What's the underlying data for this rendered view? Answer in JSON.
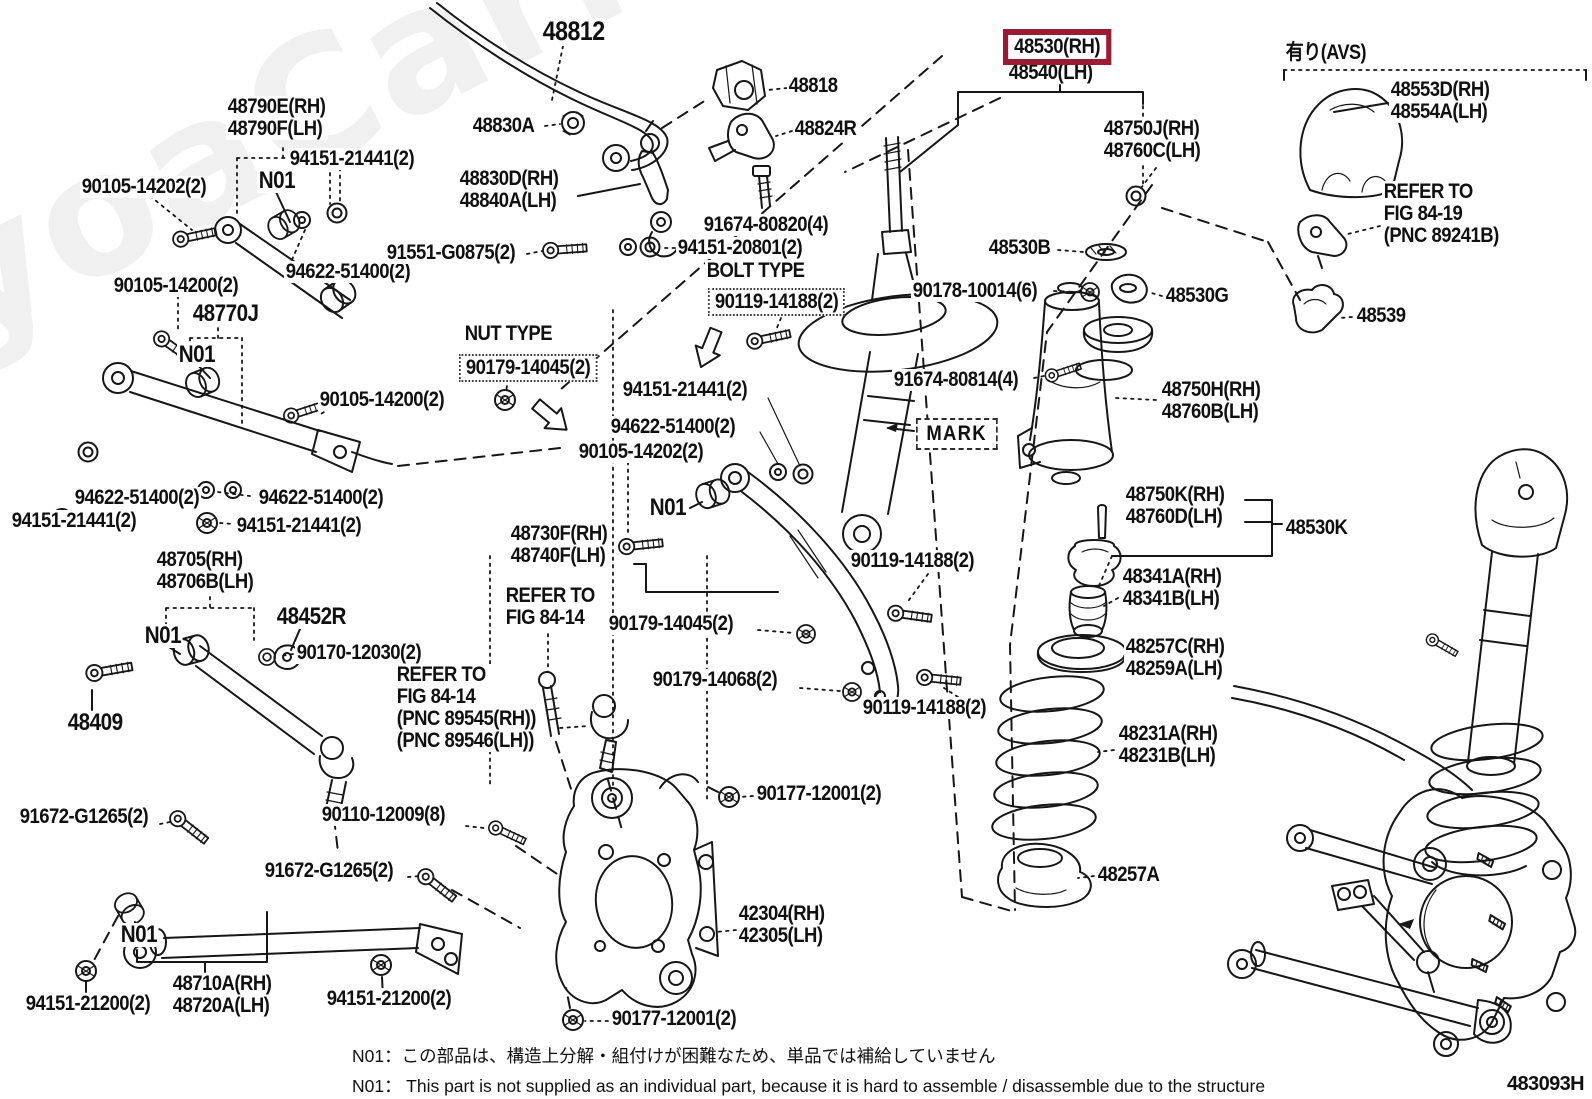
{
  "page": {
    "background": "#ffffff",
    "line_color": "#161616",
    "highlight_color": "#9c1b33",
    "diagram_code": "483093H",
    "watermark": "ToyoaCarMine.ru"
  },
  "notes": {
    "jp": "N01：この部品は、構造上分解・組付けが困難なため、単品では補給していません",
    "en": "N01： This part is not supplied as an individual part, because it is hard to assemble / disassemble due to the structure"
  },
  "labels": [
    {
      "name": "part-48812",
      "text": "48812",
      "x": 541,
      "y": 18,
      "fs": 27
    },
    {
      "name": "part-48790e-48790f",
      "text": "48790E(RH)\n48790F(LH)",
      "x": 226,
      "y": 96
    },
    {
      "name": "note-n01-a",
      "text": "N01",
      "x": 257,
      "y": 169,
      "fs": 24
    },
    {
      "name": "part-94151-21441-a",
      "text": "94151-21441(2)",
      "x": 288,
      "y": 148
    },
    {
      "name": "part-90105-14202-a",
      "text": "90105-14202(2)",
      "x": 80,
      "y": 176
    },
    {
      "name": "part-94622-51400-a",
      "text": "94622-51400(2)",
      "x": 284,
      "y": 261
    },
    {
      "name": "part-91551-g0875",
      "text": "91551-G0875(2)",
      "x": 385,
      "y": 242
    },
    {
      "name": "part-48830a",
      "text": "48830A",
      "x": 471,
      "y": 115
    },
    {
      "name": "part-48830d-48840a",
      "text": "48830D(RH)\n48840A(LH)",
      "x": 458,
      "y": 168
    },
    {
      "name": "part-48818",
      "text": "48818",
      "x": 787,
      "y": 75
    },
    {
      "name": "part-48824r",
      "text": "48824R",
      "x": 793,
      "y": 118
    },
    {
      "name": "part-91674-80820",
      "text": "91674-80820(4)",
      "x": 702,
      "y": 214
    },
    {
      "name": "part-94151-20801",
      "text": "94151-20801(2)",
      "x": 676,
      "y": 237
    },
    {
      "name": "caption-bolt-type",
      "text": "BOLT TYPE",
      "x": 705,
      "y": 260
    },
    {
      "name": "part-90119-14188-boxed",
      "text": "90119-14188(2)",
      "x": 708,
      "y": 288,
      "cls": "dotted-box"
    },
    {
      "name": "caption-nut-type",
      "text": "NUT TYPE",
      "x": 463,
      "y": 323
    },
    {
      "name": "part-90179-14045-boxed",
      "text": "90179-14045(2)",
      "x": 459,
      "y": 354,
      "cls": "dotted-box"
    },
    {
      "name": "part-90105-14200-a",
      "text": "90105-14200(2)",
      "x": 112,
      "y": 275
    },
    {
      "name": "part-48770j",
      "text": "48770J",
      "x": 191,
      "y": 302,
      "fs": 24
    },
    {
      "name": "note-n01-b",
      "text": "N01",
      "x": 177,
      "y": 343,
      "fs": 24
    },
    {
      "name": "part-90105-14200-b",
      "text": "90105-14200(2)",
      "x": 318,
      "y": 389
    },
    {
      "name": "part-94622-51400-b",
      "text": "94622-51400(2)",
      "x": 73,
      "y": 487
    },
    {
      "name": "part-94622-51400-c",
      "text": "94622-51400(2)",
      "x": 257,
      "y": 487
    },
    {
      "name": "part-94151-21441-b",
      "text": "94151-21441(2)",
      "x": 10,
      "y": 510
    },
    {
      "name": "part-94151-21441-c",
      "text": "94151-21441(2)",
      "x": 235,
      "y": 515
    },
    {
      "name": "part-48705-48706b",
      "text": "48705(RH)\n48706B(LH)",
      "x": 155,
      "y": 549
    },
    {
      "name": "part-48452r",
      "text": "48452R",
      "x": 275,
      "y": 605,
      "fs": 24
    },
    {
      "name": "note-n01-c",
      "text": "N01",
      "x": 143,
      "y": 624,
      "fs": 24
    },
    {
      "name": "part-90170-12030",
      "text": "90170-12030(2)",
      "x": 295,
      "y": 642
    },
    {
      "name": "part-48409",
      "text": "48409",
      "x": 66,
      "y": 711,
      "fs": 24
    },
    {
      "name": "part-91672-g1265-a",
      "text": "91672-G1265(2)",
      "x": 18,
      "y": 806
    },
    {
      "name": "part-90110-12009",
      "text": "90110-12009(8)",
      "x": 320,
      "y": 804
    },
    {
      "name": "part-91672-g1265-b",
      "text": "91672-G1265(2)",
      "x": 263,
      "y": 860
    },
    {
      "name": "note-n01-d",
      "text": "N01",
      "x": 119,
      "y": 923,
      "fs": 24
    },
    {
      "name": "part-94151-21200-a",
      "text": "94151-21200(2)",
      "x": 24,
      "y": 993
    },
    {
      "name": "part-48710a-48720a",
      "text": "48710A(RH)\n48720A(LH)",
      "x": 171,
      "y": 973
    },
    {
      "name": "part-94151-21200-b",
      "text": "94151-21200(2)",
      "x": 325,
      "y": 988
    },
    {
      "name": "part-42304-42305",
      "text": "42304(RH)\n42305(LH)",
      "x": 737,
      "y": 903
    },
    {
      "name": "part-90177-12001-a",
      "text": "90177-12001(2)",
      "x": 755,
      "y": 783
    },
    {
      "name": "part-90177-12001-b",
      "text": "90177-12001(2)",
      "x": 610,
      "y": 1008
    },
    {
      "name": "part-48730f-48740f",
      "text": "48730F(RH)\n48740F(LH)",
      "x": 509,
      "y": 523
    },
    {
      "name": "caption-refer-fig-84-14-a",
      "text": "REFER TO\nFIG 84-14",
      "x": 504,
      "y": 585
    },
    {
      "name": "part-90179-14045-b",
      "text": "90179-14045(2)",
      "x": 607,
      "y": 613
    },
    {
      "name": "part-90179-14068",
      "text": "90179-14068(2)",
      "x": 651,
      "y": 669
    },
    {
      "name": "caption-refer-fig-84-14-b",
      "text": "REFER TO\nFIG 84-14\n(PNC 89545(RH))\n(PNC 89546(LH))",
      "x": 395,
      "y": 664
    },
    {
      "name": "part-94151-21441-mid",
      "text": "94151-21441(2)",
      "x": 621,
      "y": 379
    },
    {
      "name": "part-94622-51400-mid",
      "text": "94622-51400(2)",
      "x": 609,
      "y": 416
    },
    {
      "name": "part-90105-14202-mid",
      "text": "90105-14202(2)",
      "x": 577,
      "y": 441
    },
    {
      "name": "note-n01-mid",
      "text": "N01",
      "x": 648,
      "y": 496,
      "fs": 24
    },
    {
      "name": "part-48530-rh-selected",
      "text": "48530(RH)",
      "x": 1003,
      "y": 29,
      "cls": "highlight",
      "interactable": true
    },
    {
      "name": "part-48540-lh",
      "text": "48540(LH)",
      "x": 1007,
      "y": 62
    },
    {
      "name": "part-48750j-48760c",
      "text": "48750J(RH)\n48760C(LH)",
      "x": 1102,
      "y": 118
    },
    {
      "name": "part-48530b",
      "text": "48530B",
      "x": 987,
      "y": 237
    },
    {
      "name": "part-90178-10014",
      "text": "90178-10014(6)",
      "x": 911,
      "y": 280
    },
    {
      "name": "part-48530g",
      "text": "48530G",
      "x": 1164,
      "y": 285
    },
    {
      "name": "part-48539",
      "text": "48539",
      "x": 1355,
      "y": 305
    },
    {
      "name": "part-91674-80814",
      "text": "91674-80814(4)",
      "x": 892,
      "y": 369
    },
    {
      "name": "part-48750h-48760b",
      "text": "48750H(RH)\n48760B(LH)",
      "x": 1160,
      "y": 379
    },
    {
      "name": "caption-mark",
      "text": "MARK",
      "x": 916,
      "y": 418,
      "cls": "mark-box"
    },
    {
      "name": "part-48750k-48760d",
      "text": "48750K(RH)\n48760D(LH)",
      "x": 1124,
      "y": 484
    },
    {
      "name": "part-48530k",
      "text": "48530K",
      "x": 1284,
      "y": 517
    },
    {
      "name": "part-48341a-48341b",
      "text": "48341A(RH)\n48341B(LH)",
      "x": 1121,
      "y": 566
    },
    {
      "name": "part-48257c-48259a",
      "text": "48257C(RH)\n48259A(LH)",
      "x": 1124,
      "y": 636
    },
    {
      "name": "part-48231a-48231b",
      "text": "48231A(RH)\n48231B(LH)",
      "x": 1117,
      "y": 723
    },
    {
      "name": "part-48257a",
      "text": "48257A",
      "x": 1096,
      "y": 864
    },
    {
      "name": "part-90119-14188-a",
      "text": "90119-14188(2)",
      "x": 849,
      "y": 550
    },
    {
      "name": "part-90119-14188-b",
      "text": "90119-14188(2)",
      "x": 861,
      "y": 697
    },
    {
      "name": "caption-avs",
      "text": "有り(AVS)",
      "x": 1284,
      "y": 42,
      "cls": "jp",
      "fs": 21
    },
    {
      "name": "part-48553d-48554a",
      "text": "48553D(RH)\n48554A(LH)",
      "x": 1389,
      "y": 79
    },
    {
      "name": "caption-refer-fig-84-19",
      "text": "REFER TO\nFIG 84-19\n(PNC 89241B)",
      "x": 1382,
      "y": 181
    }
  ]
}
